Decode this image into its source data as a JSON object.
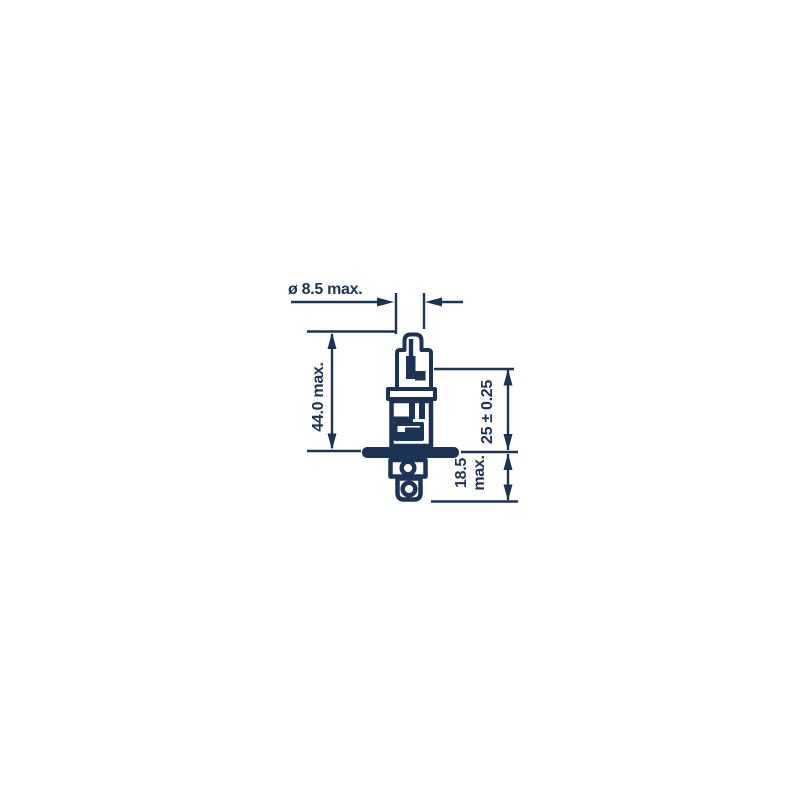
{
  "colors": {
    "ink": "#1c3356",
    "background": "#ffffff"
  },
  "dimensions": {
    "diameter": "ø 8.5 max.",
    "overall_length": "44.0 max.",
    "light_center_length": "25 ± 0.25",
    "base_length_line1": "18.5",
    "base_length_line2": "max."
  }
}
